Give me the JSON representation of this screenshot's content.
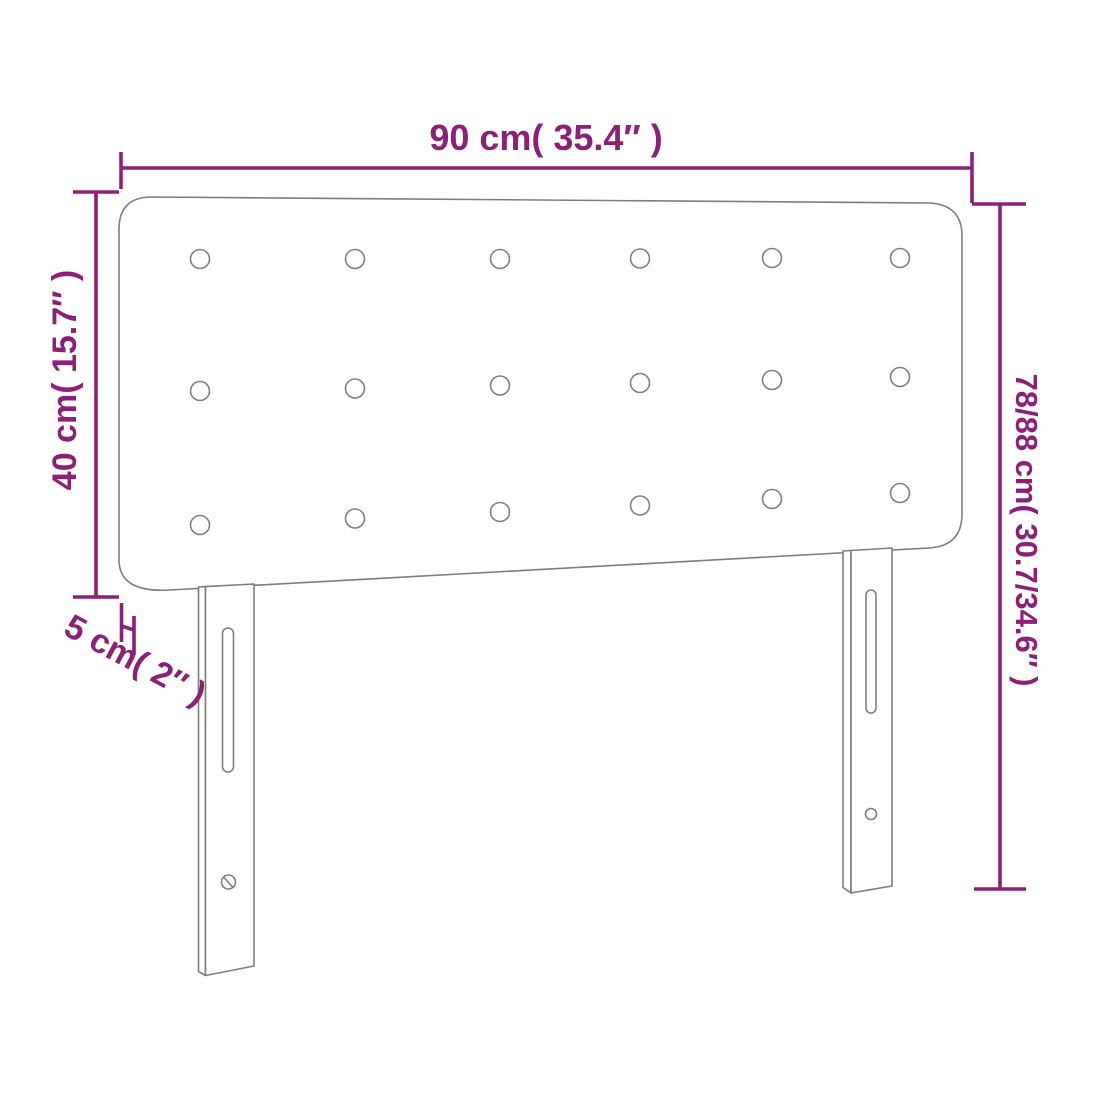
{
  "diagram": {
    "name": "headboard-dimension-diagram",
    "labels": {
      "width": "90 cm( 35.4″ )",
      "panel_height": "40 cm( 15.7″ )",
      "thickness": "5 cm( 2″ )",
      "total_height": "78/88 cm( 30.7/34.6″ )"
    },
    "measurements": {
      "width_cm": "90",
      "width_in": "35.4",
      "panel_height_cm": "40",
      "panel_height_in": "15.7",
      "thickness_cm": "5",
      "thickness_in": "2",
      "total_height_cm": "78/88",
      "total_height_in": "30.7/34.6"
    },
    "style": {
      "dimension_color": "#8b2076",
      "outline_color": "#7e7e7e",
      "background_color": "#ffffff"
    },
    "buttons": {
      "rows": 3,
      "columns": 6,
      "count": 18
    },
    "legs": {
      "count": 2,
      "slots_per_leg": 1,
      "holes_per_leg": 1
    }
  }
}
